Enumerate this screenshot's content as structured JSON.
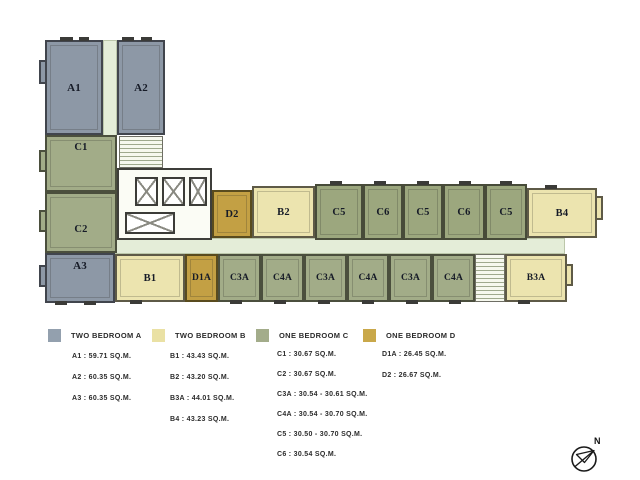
{
  "plan": {
    "vertical_units": [
      {
        "label": "A1",
        "type": "two-bedroom-a"
      },
      {
        "label": "A2",
        "type": "two-bedroom-a"
      },
      {
        "label": "C1",
        "type": "one-bedroom-c"
      },
      {
        "label": "C2",
        "type": "one-bedroom-c"
      },
      {
        "label": "A3",
        "type": "two-bedroom-a"
      }
    ],
    "top_row": [
      {
        "label": "D2",
        "type": "one-bedroom-d"
      },
      {
        "label": "B2",
        "type": "two-bedroom-b"
      },
      {
        "label": "C5",
        "type": "one-bedroom-c"
      },
      {
        "label": "C6",
        "type": "one-bedroom-c"
      },
      {
        "label": "C5",
        "type": "one-bedroom-c"
      },
      {
        "label": "C6",
        "type": "one-bedroom-c"
      },
      {
        "label": "C5",
        "type": "one-bedroom-c"
      },
      {
        "label": "B4",
        "type": "two-bedroom-b"
      }
    ],
    "bottom_row": [
      {
        "label": "B1",
        "type": "two-bedroom-b"
      },
      {
        "label": "D1A",
        "type": "one-bedroom-d"
      },
      {
        "label": "C3A",
        "type": "one-bedroom-c"
      },
      {
        "label": "C4A",
        "type": "one-bedroom-c"
      },
      {
        "label": "C3A",
        "type": "one-bedroom-c"
      },
      {
        "label": "C4A",
        "type": "one-bedroom-c"
      },
      {
        "label": "C3A",
        "type": "one-bedroom-c"
      },
      {
        "label": "C4A",
        "type": "one-bedroom-c"
      },
      {
        "label": "B3A",
        "type": "two-bedroom-b"
      }
    ]
  },
  "legend": {
    "items": [
      {
        "label": "TWO BEDROOM A",
        "color": "#93a0ae"
      },
      {
        "label": "TWO BEDROOM B",
        "color": "#eae1a4"
      },
      {
        "label": "ONE BEDROOM C",
        "color": "#a3ac8a"
      },
      {
        "label": "ONE BEDROOM D",
        "color": "#c9a84a"
      }
    ]
  },
  "areas": {
    "two_bedroom_a": [
      "A1 : 59.71 SQ.M.",
      "A2 : 60.35 SQ.M.",
      "A3 : 60.35 SQ.M."
    ],
    "two_bedroom_b": [
      "B1 : 43.43 SQ.M.",
      "B2 : 43.20 SQ.M.",
      "B3A : 44.01 SQ.M.",
      "B4 : 43.23 SQ.M."
    ],
    "one_bedroom_c": [
      "C1 : 30.67 SQ.M.",
      "C2 : 30.67 SQ.M.",
      "C3A : 30.54 - 30.61 SQ.M.",
      "C4A : 30.54 - 30.70 SQ.M.",
      "C5 : 30.50 - 30.70 SQ.M.",
      "C6 : 30.54 SQ.M."
    ],
    "one_bedroom_d": [
      "D1A : 26.45 SQ.M.",
      "D2 : 26.67 SQ.M."
    ]
  },
  "compass": {
    "label": "N"
  },
  "colors": {
    "two_bedroom_a_fill": "#8d98a6",
    "two_bedroom_b_fill": "#ece4af",
    "one_bedroom_c_fill": "#a2ac88",
    "one_bedroom_d_fill": "#c3a044",
    "corridor": "#e4edd8",
    "wall": "#4a4a44"
  }
}
